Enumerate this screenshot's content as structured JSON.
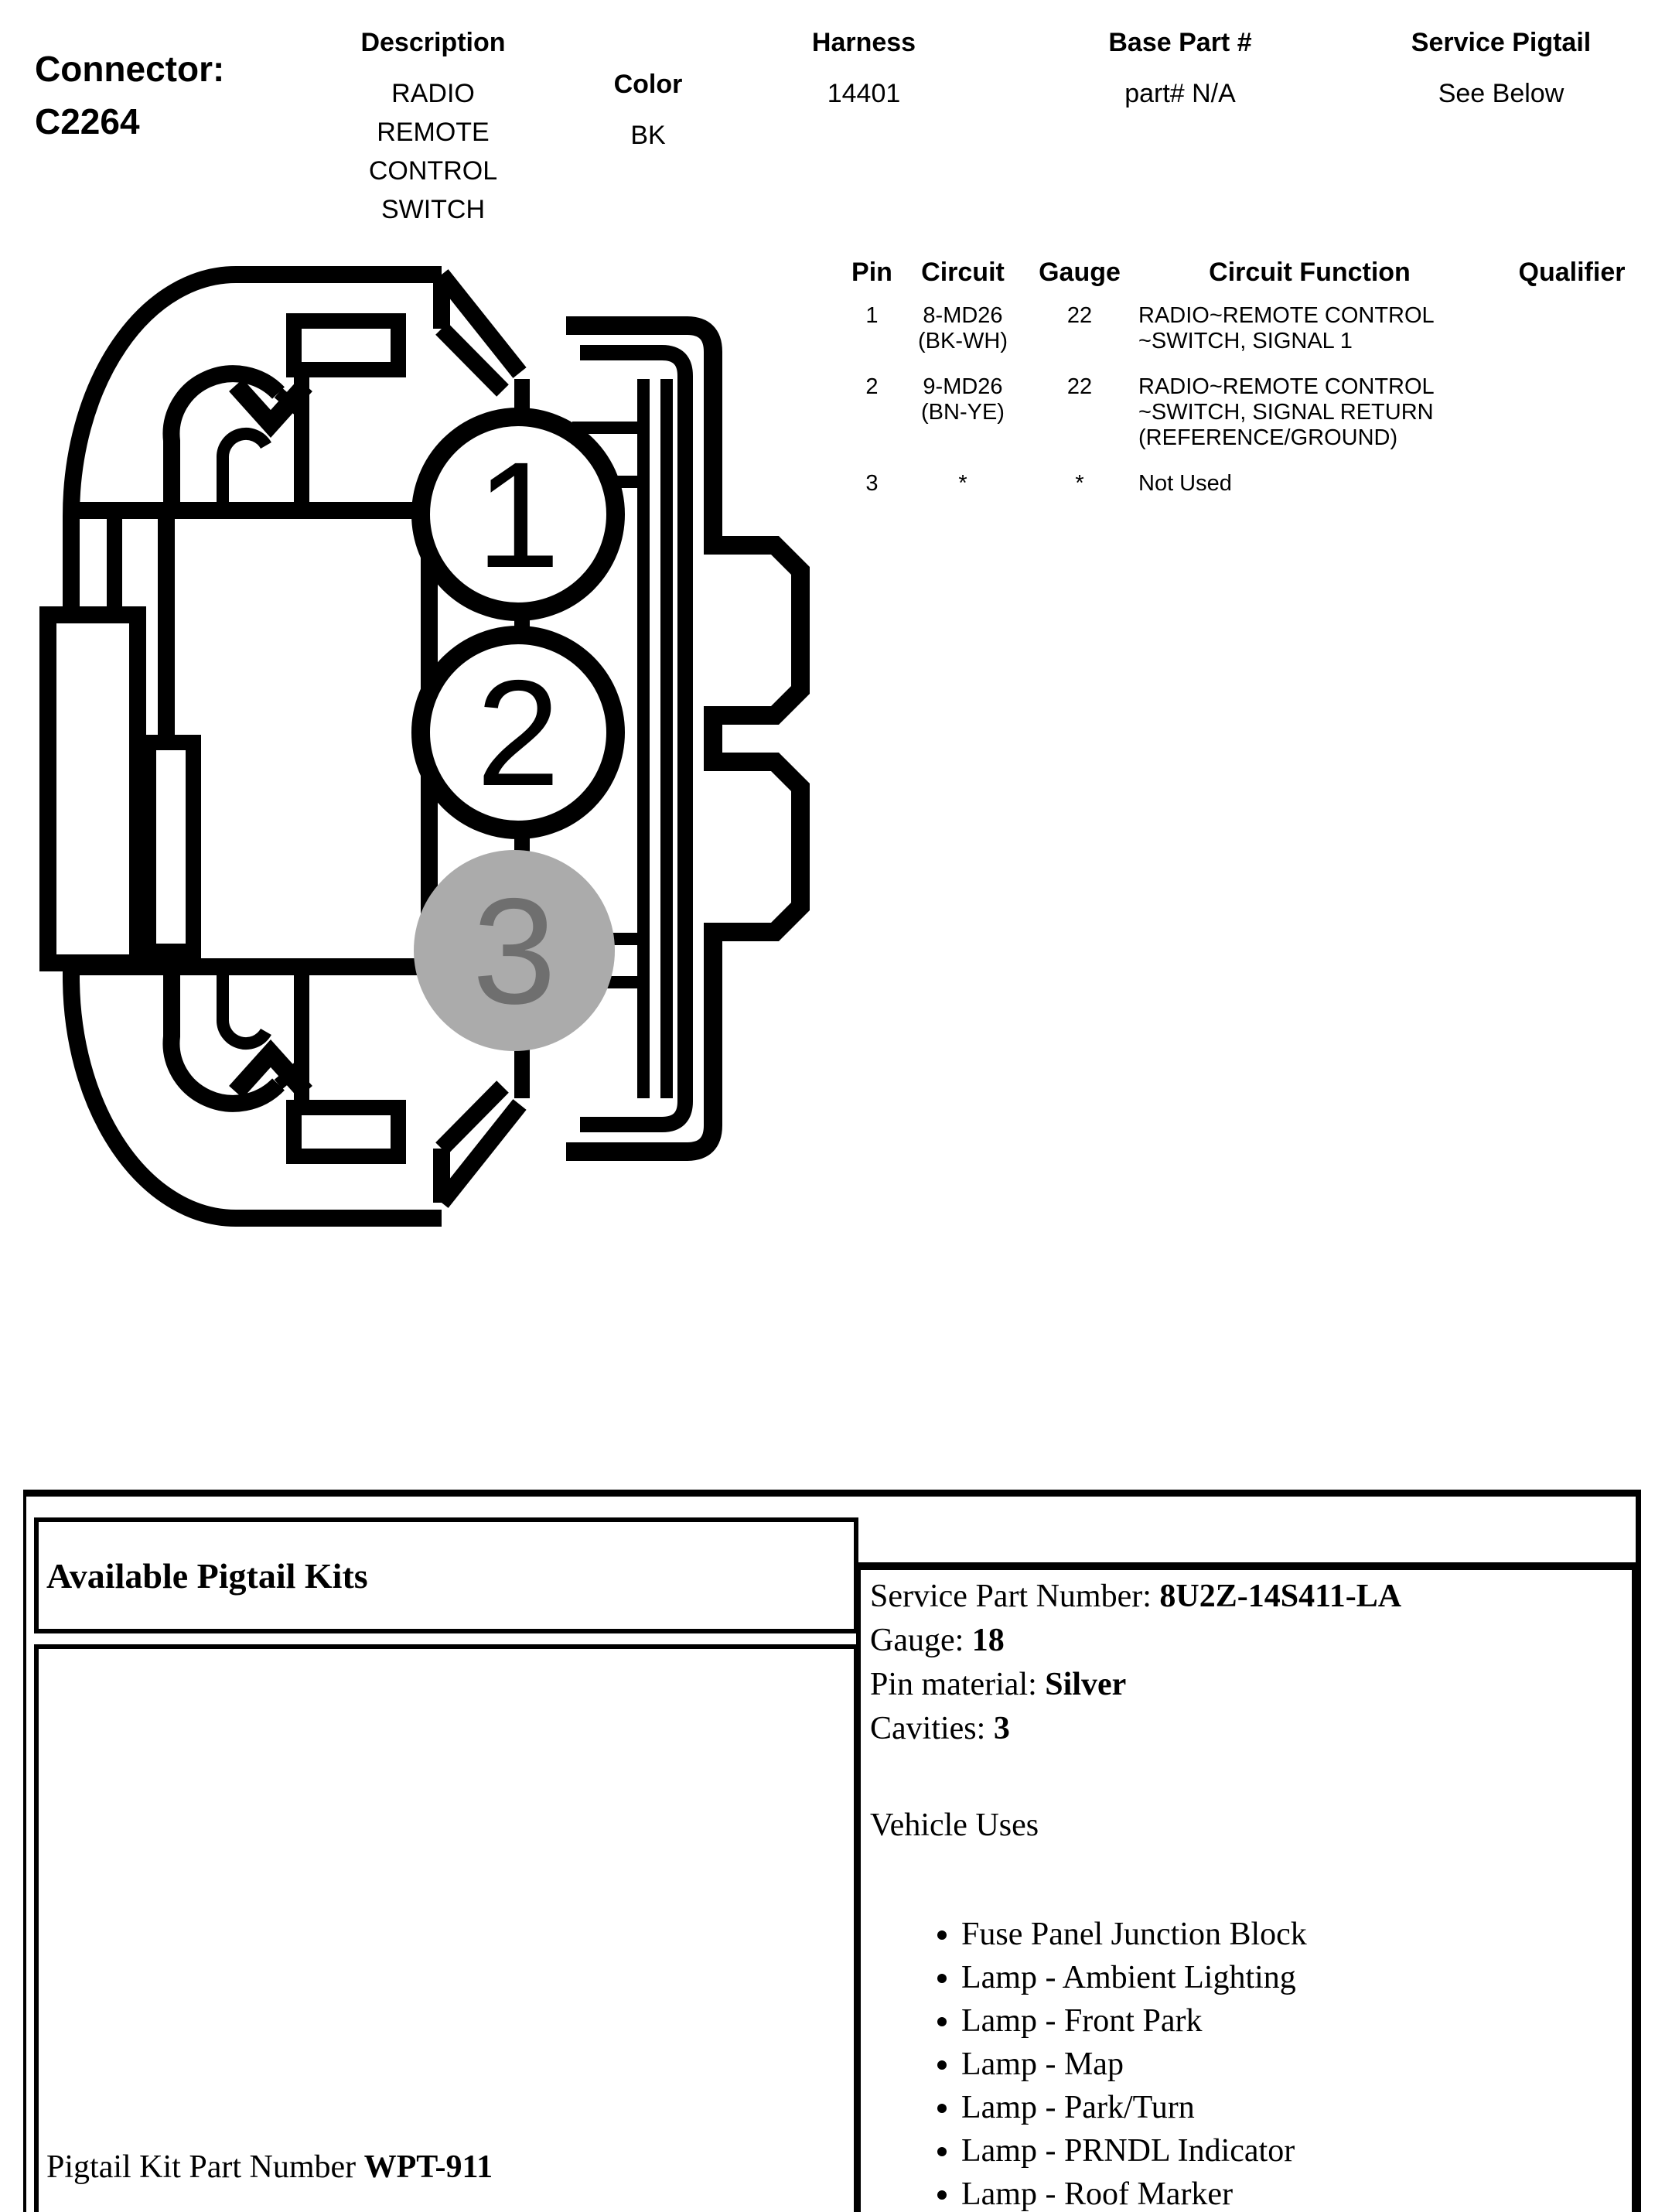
{
  "header": {
    "connector_label": "Connector:",
    "connector_id": "C2264",
    "columns": [
      {
        "label": "Description",
        "value": "RADIO REMOTE CONTROL SWITCH"
      },
      {
        "label": "Color",
        "value": "BK"
      },
      {
        "label": "Harness",
        "value": "14401"
      },
      {
        "label": "Base Part #",
        "value": "part# N/A"
      },
      {
        "label": "Service Pigtail",
        "value": "See Below"
      }
    ]
  },
  "pin_table": {
    "headers": [
      "Pin",
      "Circuit",
      "Gauge",
      "Circuit Function",
      "Qualifier"
    ],
    "rows": [
      {
        "pin": "1",
        "circuit": "8-MD26\n(BK-WH)",
        "gauge": "22",
        "function": "RADIO~REMOTE CONTROL\n~SWITCH, SIGNAL 1",
        "qualifier": ""
      },
      {
        "pin": "2",
        "circuit": "9-MD26\n(BN-YE)",
        "gauge": "22",
        "function": "RADIO~REMOTE CONTROL\n~SWITCH, SIGNAL RETURN\n(REFERENCE/GROUND)",
        "qualifier": ""
      },
      {
        "pin": "3",
        "circuit": "*",
        "gauge": "*",
        "function": "Not Used",
        "qualifier": ""
      }
    ]
  },
  "diagram": {
    "pins": [
      {
        "number": "1"
      },
      {
        "number": "2"
      },
      {
        "number": "3"
      }
    ],
    "colors": {
      "line": "#000000",
      "pin3_fill": "#ababab",
      "pin3_text": "#6f6f6f"
    }
  },
  "pigtail": {
    "kits_title": "Available Pigtail Kits",
    "kit_part_label": "Pigtail Kit Part Number ",
    "kit_part_number": "WPT-911",
    "details": [
      {
        "label": "Service Part Number: ",
        "value": "8U2Z-14S411-LA"
      },
      {
        "label": "Gauge: ",
        "value": "18"
      },
      {
        "label": "Pin material: ",
        "value": "Silver"
      },
      {
        "label": "Cavities: ",
        "value": "3"
      }
    ],
    "vehicle_uses_title": "Vehicle Uses",
    "vehicle_uses": [
      "Fuse Panel Junction Block",
      "Lamp - Ambient Lighting",
      "Lamp - Front Park",
      "Lamp - Map",
      "Lamp - Park/Turn",
      "Lamp - PRNDL Indicator",
      "Lamp - Roof Marker"
    ]
  }
}
